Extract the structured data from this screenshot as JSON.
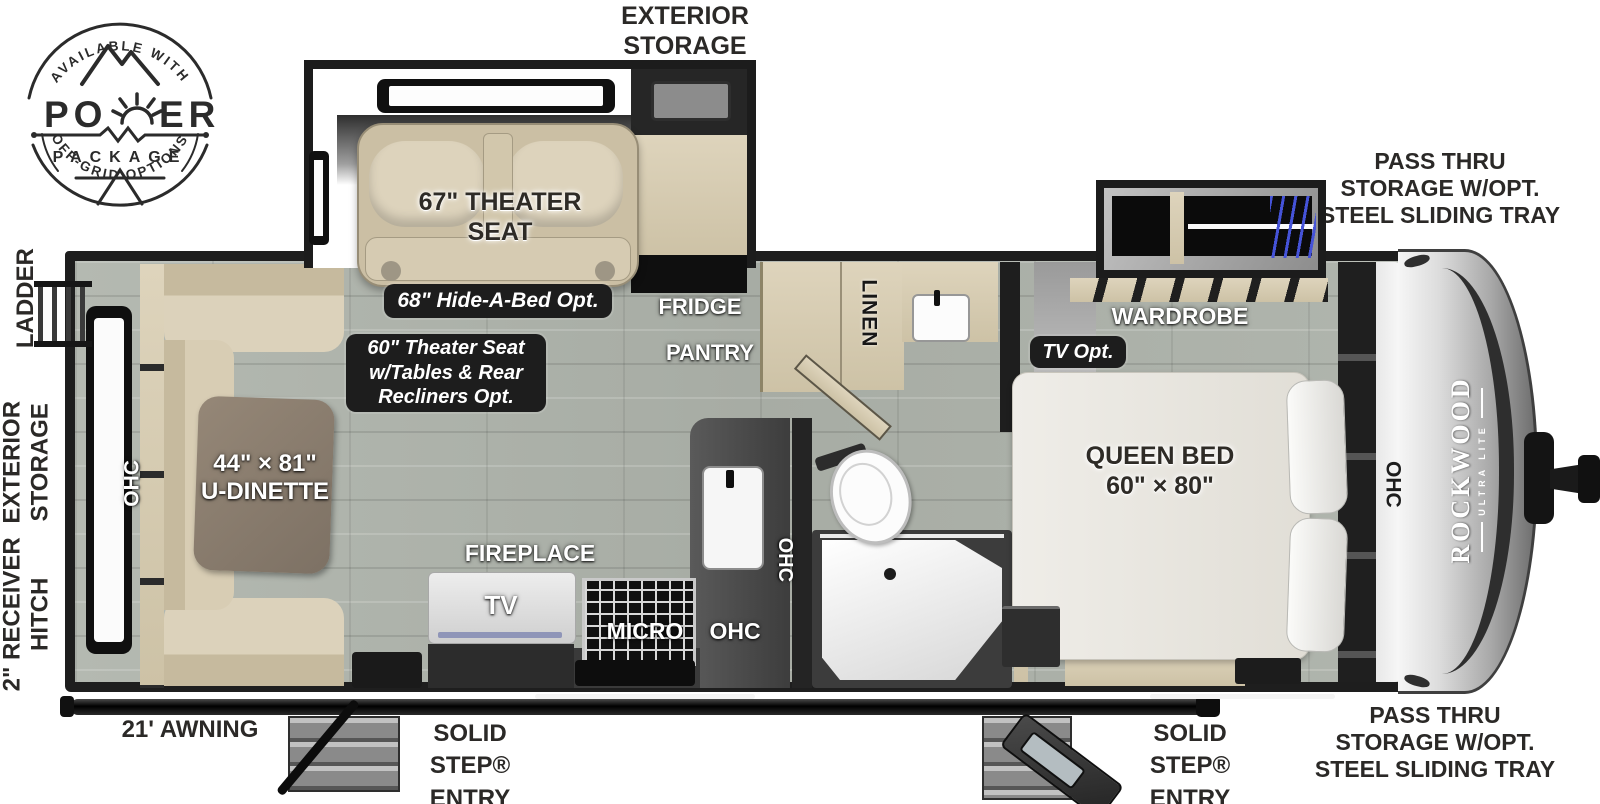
{
  "logo": {
    "arc_top": "AVAILABLE WITH",
    "word_pre": "PO",
    "word_post": "ER",
    "package": "PACKAGE",
    "arc_bottom": "OFF-GRID OPTIONS"
  },
  "exterior": {
    "storage_top": "EXTERIOR\nSTORAGE",
    "pass_thru_top": "PASS THRU\nSTORAGE W/OPT.\nSTEEL SLIDING TRAY",
    "pass_thru_bottom": "PASS THRU\nSTORAGE W/OPT.\nSTEEL SLIDING TRAY",
    "ladder": "LADDER",
    "storage_left": "EXTERIOR\nSTORAGE",
    "receiver_hitch": "2\" RECEIVER\nHITCH",
    "awning": "21' AWNING",
    "entry_left": "SOLID STEP®\nENTRY",
    "entry_right": "SOLID STEP®\nENTRY"
  },
  "living": {
    "theater_seat": "67\" THEATER\nSEAT",
    "hide_a_bed_badge": "68\" Hide-A-Bed Opt.",
    "theater_opt_badge": "60\" Theater Seat\nw/Tables & Rear\nRecliners Opt.",
    "fridge": "FRIDGE",
    "pantry": "PANTRY",
    "dinette": "44\" × 81\"\nU-DINETTE",
    "ohc_dinette": "OHC",
    "fireplace": "FIREPLACE",
    "tv": "TV",
    "micro": "MICRO",
    "ohc_kitchen": "OHC",
    "ohc_sink": "OHC"
  },
  "bath": {
    "linen": "LINEN"
  },
  "bedroom": {
    "wardrobe": "WARDROBE",
    "tv_opt_badge": "TV Opt.",
    "queen_bed": "QUEEN BED\n60\" × 80\"",
    "ohc_front": "OHC"
  },
  "brand": {
    "name": "ROCKWOOD",
    "tagline": "ULTRA LITE"
  },
  "colors": {
    "wall": "#1d1d1d",
    "floor": "#adb2ab",
    "wood": "#d8cdb4",
    "badge": "#1d1d1d",
    "hanger_blue": "#4553d8"
  }
}
